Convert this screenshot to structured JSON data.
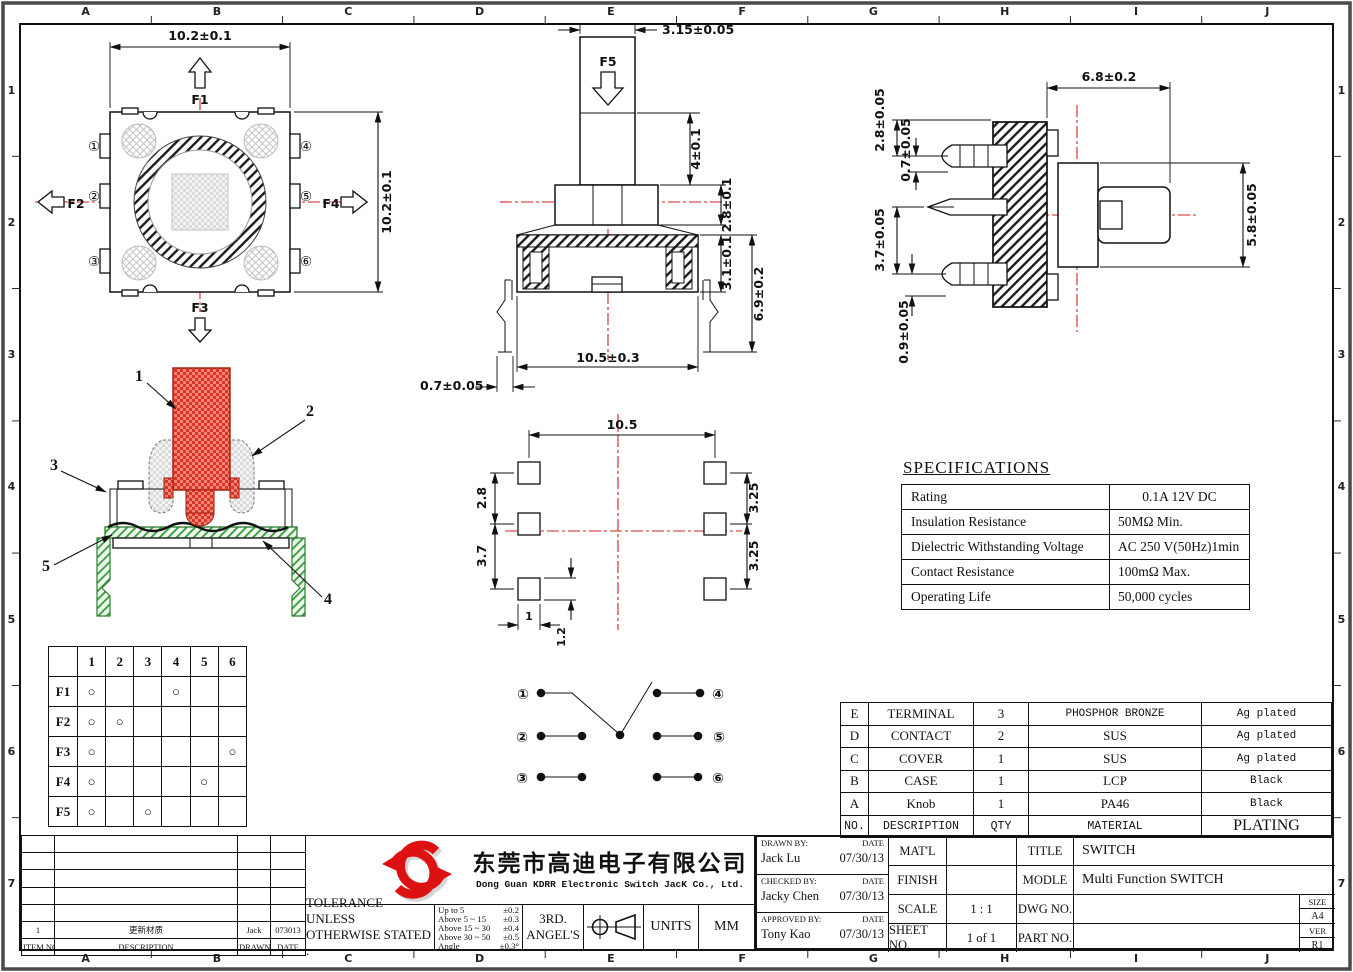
{
  "sheet": {
    "cols": [
      "A",
      "B",
      "C",
      "D",
      "E",
      "F",
      "G",
      "H",
      "I",
      "J"
    ],
    "rows": [
      "1",
      "2",
      "3",
      "4",
      "5",
      "6",
      "7"
    ]
  },
  "colors": {
    "centerline": "#cc2222",
    "knob_red": "#e2402f",
    "base_green": "#3f9d3f",
    "logo_red": "#dd1111"
  },
  "top_view": {
    "dim_width": "10.2±0.1",
    "dim_height": "10.2±0.1",
    "f1": "F1",
    "f2": "F2",
    "f3": "F3",
    "f4": "F4",
    "pin1": "①",
    "pin2": "②",
    "pin3": "③",
    "pin4": "④",
    "pin5": "⑤",
    "pin6": "⑥"
  },
  "front_view": {
    "f5": "F5",
    "stem_width": "3.15±0.05",
    "stem_height": "4±0.1",
    "collar_height": "2.8±0.1",
    "upper_body_height": "3.1±0.1",
    "overall_height": "6.9±0.2",
    "lead_span": "10.5±0.3",
    "lead_width": "0.7±0.05"
  },
  "side_view": {
    "body_width": "6.8±0.2",
    "pin_offset_top": "2.8±0.05",
    "pin_width": "0.7±0.05",
    "pin_pitch": "3.7±0.05",
    "pin_tip": "0.9±0.05",
    "body_height": "5.8±0.05"
  },
  "section_view": {
    "part1": "1",
    "part2": "2",
    "part3": "3",
    "part4": "4",
    "part5": "5"
  },
  "pcb_layout": {
    "pad_span": "10.5",
    "row_gap_upper": "2.8",
    "row_gap_lower": "3.7",
    "right_gap_upper": "3.25",
    "right_gap_lower": "3.25",
    "pad_width": "1",
    "pad_height": "1.2"
  },
  "function_table": {
    "columns": [
      "1",
      "2",
      "3",
      "4",
      "5",
      "6"
    ],
    "rows": [
      {
        "label": "F1",
        "cells": [
          "○",
          "",
          "",
          "○",
          "",
          ""
        ]
      },
      {
        "label": "F2",
        "cells": [
          "○",
          "○",
          "",
          "",
          "",
          ""
        ]
      },
      {
        "label": "F3",
        "cells": [
          "○",
          "",
          "",
          "",
          "",
          "○"
        ]
      },
      {
        "label": "F4",
        "cells": [
          "○",
          "",
          "",
          "",
          "○",
          ""
        ]
      },
      {
        "label": "F5",
        "cells": [
          "○",
          "",
          "○",
          "",
          "",
          ""
        ]
      }
    ]
  },
  "circuit": {
    "pin1": "①",
    "pin2": "②",
    "pin3": "③",
    "pin4": "④",
    "pin5": "⑤",
    "pin6": "⑥"
  },
  "specifications": {
    "title": "SPECIFICATIONS",
    "rows": [
      {
        "name": "Rating",
        "value": "0.1A 12V DC"
      },
      {
        "name": "Insulation Resistance",
        "value": "50MΩ Min."
      },
      {
        "name": "Dielectric Withstanding Voltage",
        "value": "AC 250 V(50Hz)1min"
      },
      {
        "name": "Contact Resistance",
        "value": "100mΩ Max."
      },
      {
        "name": "Operating Life",
        "value": "50,000 cycles"
      }
    ]
  },
  "bom": {
    "header": {
      "no": "NO.",
      "description": "DESCRIPTION",
      "qty": "QTY",
      "material": "MATERIAL",
      "plating": "PLATING"
    },
    "rows": [
      {
        "no": "E",
        "description": "TERMINAL",
        "qty": "3",
        "material": "PHOSPHOR BRONZE",
        "plating": "Ag plated"
      },
      {
        "no": "D",
        "description": "CONTACT",
        "qty": "2",
        "material": "SUS",
        "plating": "Ag plated"
      },
      {
        "no": "C",
        "description": "COVER",
        "qty": "1",
        "material": "SUS",
        "plating": "Ag plated"
      },
      {
        "no": "B",
        "description": "CASE",
        "qty": "1",
        "material": "LCP",
        "plating": "Black"
      },
      {
        "no": "A",
        "description": "Knob",
        "qty": "1",
        "material": "PA46",
        "plating": "Black"
      }
    ]
  },
  "revision_table": {
    "header": {
      "item": "ITEM NO.",
      "description": "DESCRIPTION",
      "drawn": "DRAWN",
      "date": "DATE"
    },
    "rows": [
      {
        "item": "1",
        "description": "更新材质",
        "drawn": "Jack",
        "date": "073013"
      }
    ]
  },
  "company": {
    "name_cn": "东莞市高迪电子有限公司",
    "name_en": "Dong Guan KDRR  Electronic Switch JacK Co., Ltd."
  },
  "tolerance": {
    "line1": "TOLERANCE UNLESS",
    "line2": "OTHERWISE STATED :",
    "items": [
      {
        "range": "Up  to 5",
        "value": "±0.2"
      },
      {
        "range": "Above 5  ~ 15",
        "value": "±0.3"
      },
      {
        "range": "Above 15 ~ 30",
        "value": "±0.4"
      },
      {
        "range": "Above 30 ~ 50",
        "value": "±0.5"
      },
      {
        "range": "Angle",
        "value": "±0.3°"
      }
    ],
    "projection_line1": "3RD.",
    "projection_line2": "ANGEL'S",
    "units_label": "UNITS",
    "units_value": "MM"
  },
  "title_block": {
    "drawn_by_label": "DRAWN BY:",
    "checked_by_label": "CHECKED BY:",
    "approved_by_label": "APPROVED BY:",
    "date_label": "DATE",
    "drawn_by": "Jack  Lu",
    "drawn_date": "07/30/13",
    "checked_by": "Jacky Chen",
    "checked_date": "07/30/13",
    "approved_by": "Tony Kao",
    "approved_date": "07/30/13",
    "matl_label": "MAT'L",
    "matl_value": "",
    "finish_label": "FINISH",
    "finish_value": "",
    "scale_label": "SCALE",
    "scale_value": "1 : 1",
    "sheet_label": "SHEET NO.",
    "sheet_value": "1 of 1",
    "title_label": "TITLE",
    "title_value": "SWITCH",
    "model_label": "MODLE",
    "model_value": "Multi Function  SWITCH",
    "dwg_label": "DWG NO.",
    "dwg_value": "",
    "part_label": "PART NO.",
    "part_value": "",
    "size_label": "SIZE",
    "size_value": "A4",
    "ver_label": "VER",
    "ver_value": "R1"
  }
}
